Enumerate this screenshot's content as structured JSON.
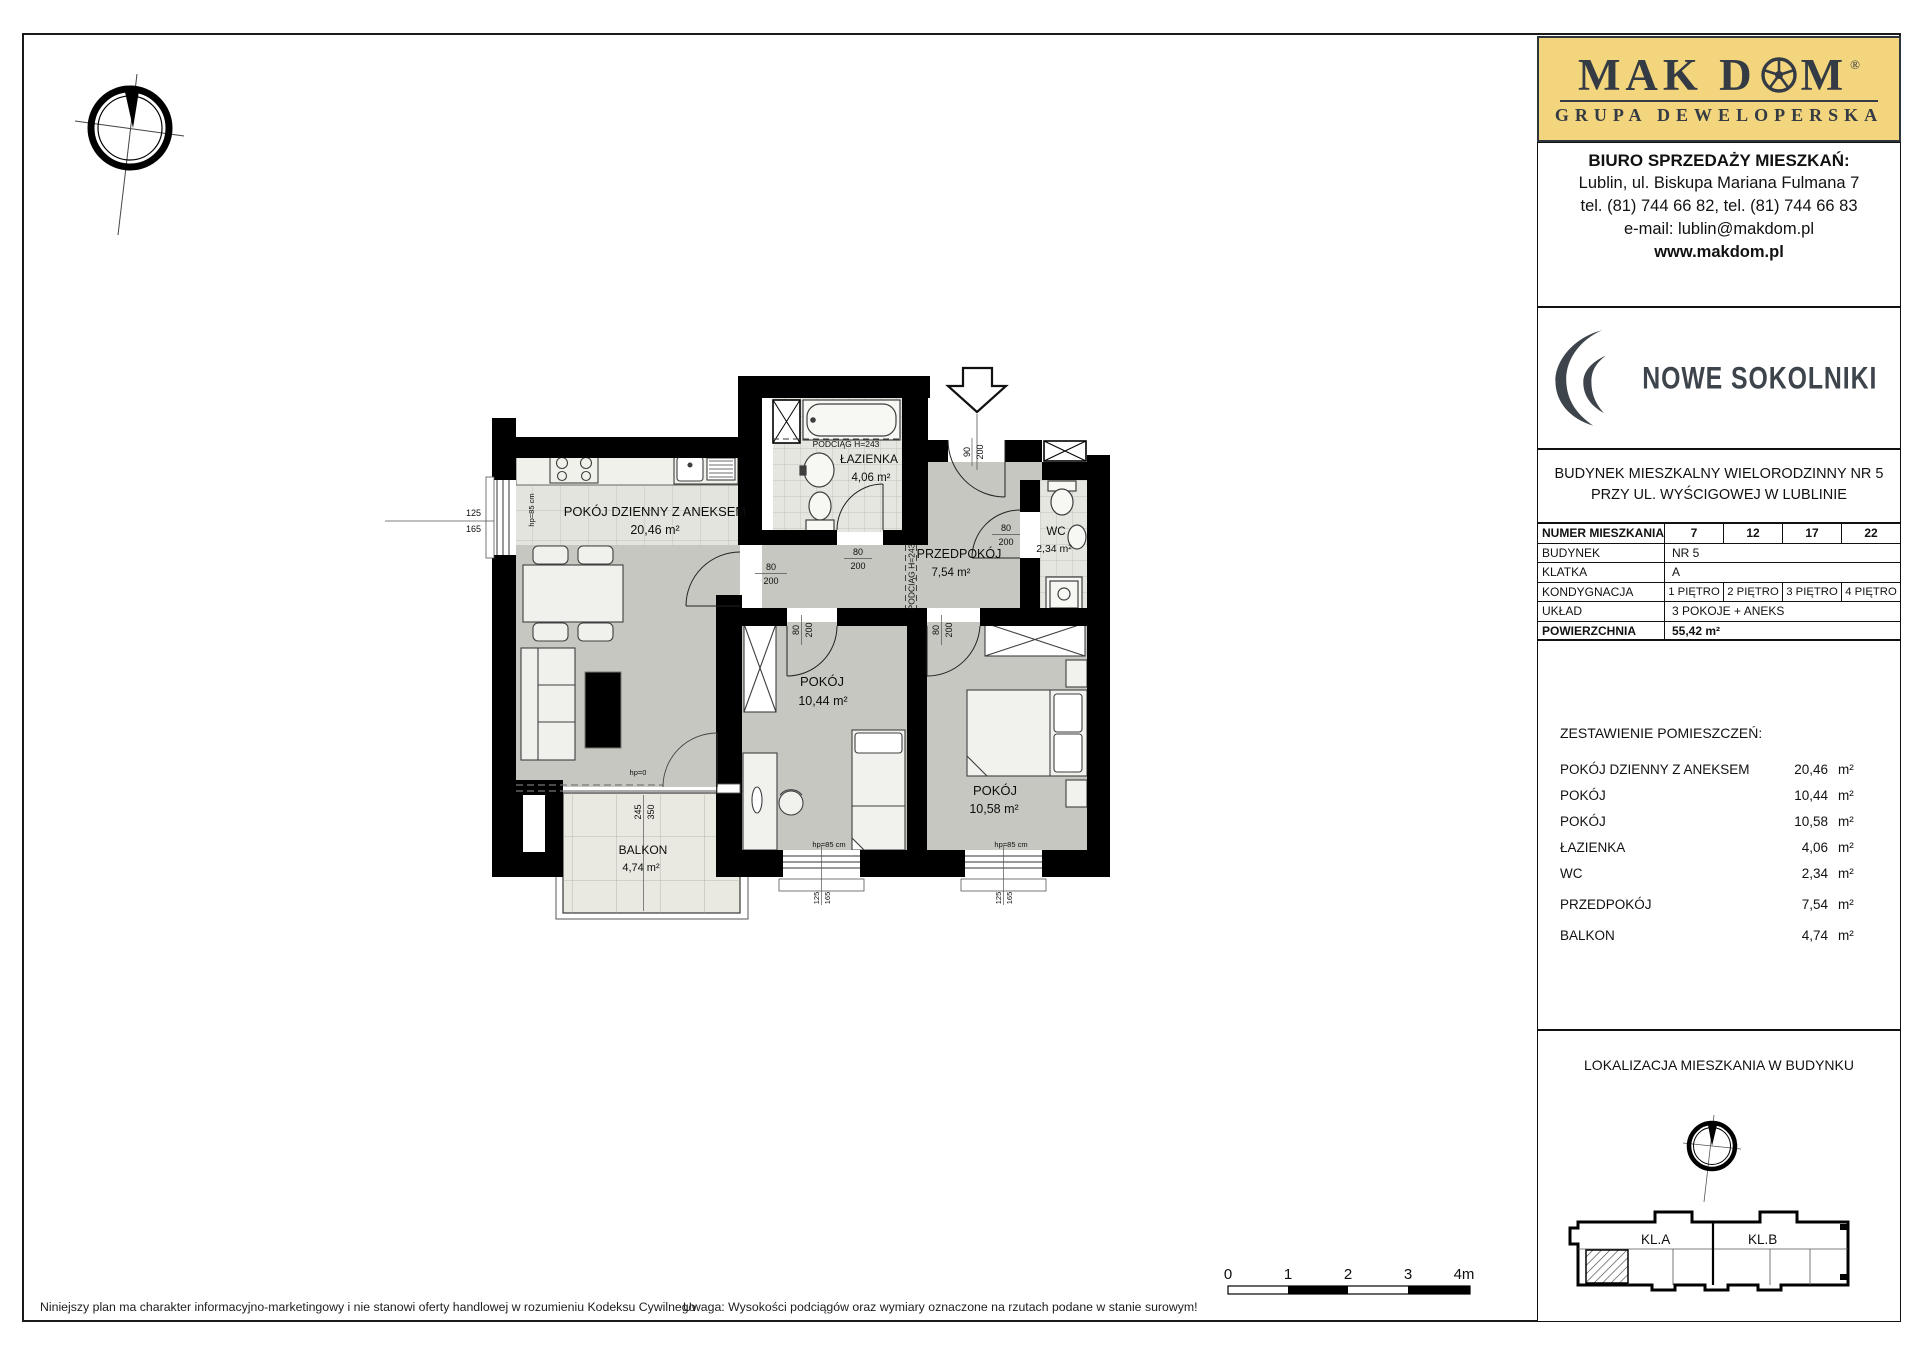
{
  "brand": {
    "prefix": "MAK D",
    "suffix": "M",
    "registered": "®",
    "subtitle": "GRUPA DEWELOPERSKA",
    "colors": {
      "accent_gold": "#f2d57c",
      "ink": "#343b44"
    }
  },
  "office": {
    "heading": "BIURO SPRZEDAŻY MIESZKAŃ:",
    "address": "Lublin, ul. Biskupa Mariana Fulmana 7",
    "phones": "tel. (81) 744 66 82, tel. (81) 744 66 83",
    "email": "e-mail: lublin@makdom.pl",
    "website": "www.makdom.pl"
  },
  "project": {
    "name": "NOWE SOKOLNIKI"
  },
  "building": {
    "line1": "BUDYNEK MIESZKALNY WIELORODZINNY NR 5",
    "line2": "PRZY UL. WYŚCIGOWEJ W LUBLINIE"
  },
  "info_table": {
    "numer_label": "NUMER MIESZKANIA",
    "numer_values": [
      "7",
      "12",
      "17",
      "22"
    ],
    "budynek_label": "BUDYNEK",
    "budynek_value": "NR 5",
    "klatka_label": "KLATKA",
    "klatka_value": "A",
    "kondygnacja_label": "KONDYGNACJA",
    "kondygnacja_values": [
      "1 PIĘTRO",
      "2 PIĘTRO",
      "3 PIĘTRO",
      "4 PIĘTRO"
    ],
    "uklad_label": "UKŁAD",
    "uklad_value": "3 POKOJE + ANEKS",
    "powierzchnia_label": "POWIERZCHNIA",
    "powierzchnia_value": "55,42 m²"
  },
  "rooms": {
    "heading": "ZESTAWIENIE POMIESZCZEŃ:",
    "unit": "m²",
    "items": [
      {
        "name": "POKÓJ DZIENNY Z ANEKSEM",
        "area": "20,46"
      },
      {
        "name": "POKÓJ",
        "area": "10,44"
      },
      {
        "name": "POKÓJ",
        "area": "10,58"
      },
      {
        "name": "ŁAZIENKA",
        "area": "4,06"
      },
      {
        "name": "WC",
        "area": "2,34"
      },
      {
        "name": "PRZEDPOKÓJ",
        "area": "7,54"
      },
      {
        "name": "BALKON",
        "area": "4,74"
      }
    ]
  },
  "plan": {
    "living": {
      "name": "POKÓJ DZIENNY Z ANEKSEM",
      "area": "20,46 m²"
    },
    "bath": {
      "name": "ŁAZIENKA",
      "area": "4,06 m²"
    },
    "wc": {
      "name": "WC",
      "area": "2,34 m²"
    },
    "hall": {
      "name": "PRZEDPOKÓJ",
      "area": "7,54 m²"
    },
    "room1": {
      "name": "POKÓJ",
      "area": "10,44 m²"
    },
    "room2": {
      "name": "POKÓJ",
      "area": "10,58 m²"
    },
    "balcony": {
      "name": "BALKON",
      "area": "4,74 m²"
    },
    "beam": "PODCIĄG H=243",
    "dims": {
      "d80": "80",
      "d90": "90",
      "d200": "200",
      "d125": "125",
      "d165": "165",
      "d245": "245",
      "d350": "350",
      "sill85": "hp=85 cm",
      "sill0": "hp=0"
    }
  },
  "localization": {
    "heading": "LOKALIZACJA MIESZKANIA W BUDYNKU",
    "kl_a": "KL.A",
    "kl_b": "KL.B"
  },
  "scalebar": {
    "labels": [
      "0",
      "1",
      "2",
      "3",
      "4m"
    ]
  },
  "footnotes": {
    "left": "Niniejszy plan ma charakter informacyjno-marketingowy i nie stanowi oferty handlowej w rozumieniu Kodeksu Cywilnego",
    "right": "Uwaga: Wysokości podciągów oraz wymiary oznaczone na rzutach podane w stanie surowym!"
  }
}
